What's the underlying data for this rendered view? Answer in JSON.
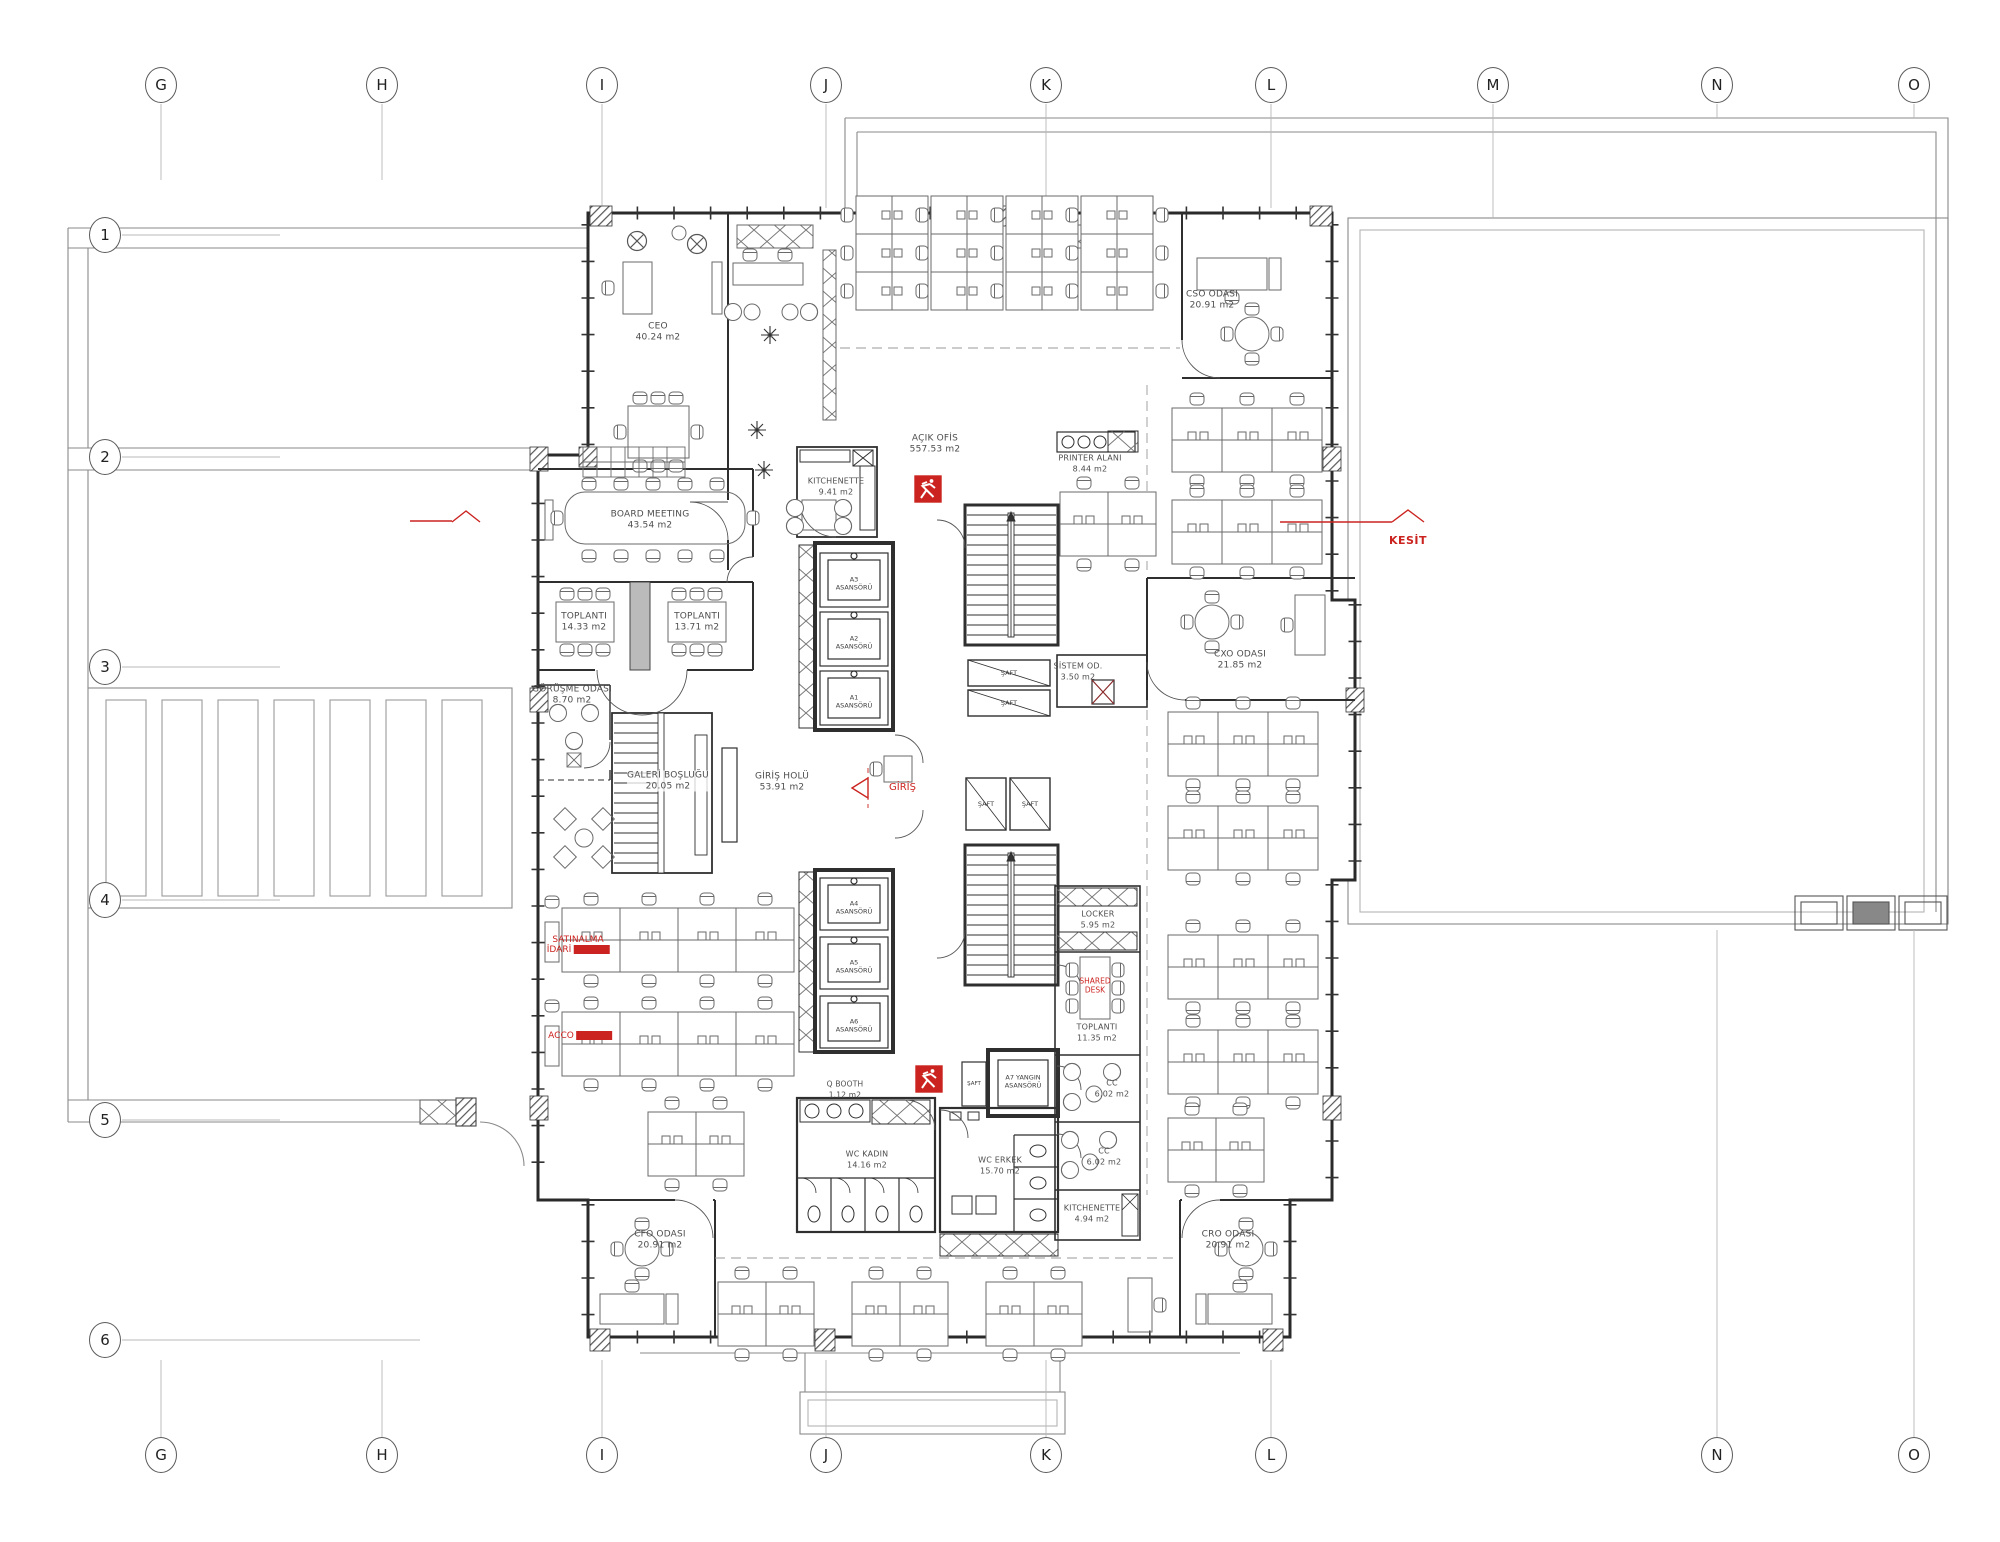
{
  "drawing": {
    "type": "architectural floor plan",
    "units": "m2"
  },
  "grid": {
    "top": [
      "G",
      "H",
      "I",
      "J",
      "K",
      "L",
      "M",
      "N",
      "O"
    ],
    "bottom": [
      "G",
      "H",
      "I",
      "J",
      "K",
      "L",
      "N",
      "O"
    ],
    "left": [
      "1",
      "2",
      "3",
      "4",
      "5",
      "6"
    ]
  },
  "rooms": {
    "ceo": {
      "name": "CEO",
      "area": "40.24 m2"
    },
    "board": {
      "name": "BOARD MEETING",
      "area": "43.54 m2"
    },
    "toplanti1": {
      "name": "TOPLANTI",
      "area": "14.33 m2"
    },
    "toplanti2": {
      "name": "TOPLANTI",
      "area": "13.71 m2"
    },
    "gorusme": {
      "name": "GÖRÜŞME ODASI",
      "area": "8.70 m2"
    },
    "galeri": {
      "name": "GALERİ BOŞLUĞU",
      "area": "20.05 m2"
    },
    "giris_holu": {
      "name": "GİRİŞ HOLÜ",
      "area": "53.91 m2"
    },
    "kitchenette1": {
      "name": "KITCHENETTE",
      "area": "9.41 m2"
    },
    "acik_ofis": {
      "name": "AÇIK OFİS",
      "area": "557.53 m2"
    },
    "printer": {
      "name": "PRINTER ALANI",
      "area": "8.44 m2"
    },
    "sistem": {
      "name": "SİSTEM OD.",
      "area": "3.50 m2"
    },
    "cxo": {
      "name": "CXO ODASI",
      "area": "21.85 m2"
    },
    "cso": {
      "name": "CSO ODASI",
      "area": "20.91 m2"
    },
    "locker": {
      "name": "LOCKER",
      "area": "5.95 m2"
    },
    "toplanti3": {
      "name": "TOPLANTI",
      "area": "11.35 m2"
    },
    "cc1": {
      "name": "CC",
      "area": "6.02 m2"
    },
    "cc2": {
      "name": "CC",
      "area": "6.02 m2"
    },
    "kitchenette2": {
      "name": "KITCHENETTE",
      "area": "4.94 m2"
    },
    "qbooth": {
      "name": "Q BOOTH",
      "area": "1.12 m2"
    },
    "wc_kadin": {
      "name": "WC KADIN",
      "area": "14.16 m2"
    },
    "wc_erkek": {
      "name": "WC ERKEK",
      "area": "15.70 m2"
    },
    "cfo": {
      "name": "CFO ODASI",
      "area": "20.91 m2"
    },
    "cro": {
      "name": "CRO ODASI",
      "area": "20.91 m2"
    }
  },
  "core": {
    "saft": "ŞAFT",
    "fire_l1": "A7 YANGIN",
    "fire_l2": "ASANSÖRÜ",
    "elevators": {
      "e1": "A3",
      "e2": "A2",
      "e3": "A1",
      "e4": "A4",
      "e5": "A5",
      "e6": "A6",
      "suffix": "ASANSÖRÜ"
    }
  },
  "annotations": {
    "giris": "GİRİŞ",
    "kesit": "KESİT",
    "satinalma_l1": "SATINALMA",
    "satinalma_l2": "İDARİ",
    "accounting": "ACCO",
    "shared_l1": "SHARED",
    "shared_l2": "DESK"
  },
  "colors": {
    "red": "#cb2420",
    "wall": "#2a2a2a",
    "furniture": "#6a6a6a",
    "grid": "#b8b8b8"
  }
}
